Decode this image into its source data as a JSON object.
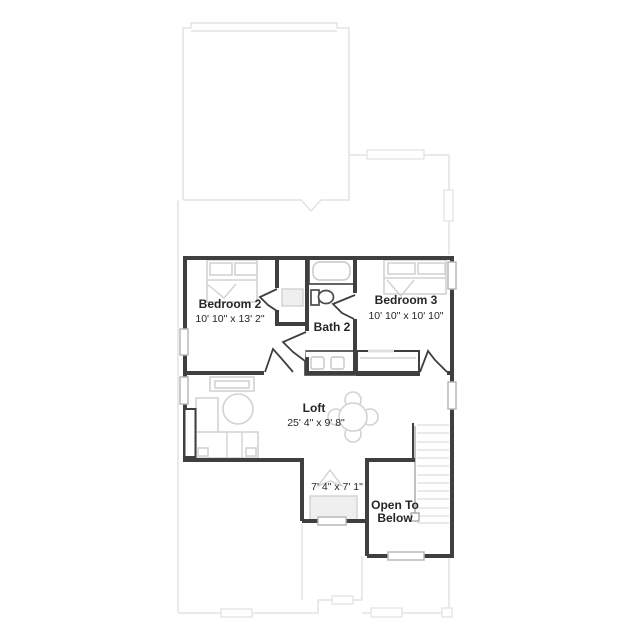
{
  "plan": {
    "colors": {
      "wall": "#3f3f3f",
      "text": "#262626",
      "furniture": "#d2d2d2",
      "below_outline": "#e3e3e3",
      "window": "#b8b8b8"
    },
    "rooms": {
      "bedroom2": {
        "name": "Bedroom 2",
        "dims": "10' 10\" x 13' 2\""
      },
      "bath2": {
        "name": "Bath 2"
      },
      "bedroom3": {
        "name": "Bedroom 3",
        "dims": "10' 10\" x 10' 10\""
      },
      "loft": {
        "name": "Loft",
        "dims": "25' 4\" x 9' 8\""
      },
      "tech_nook": {
        "dims": "7' 4\" x 7' 1\""
      },
      "open_to_below": {
        "line1": "Open To",
        "line2": "Below"
      }
    }
  }
}
